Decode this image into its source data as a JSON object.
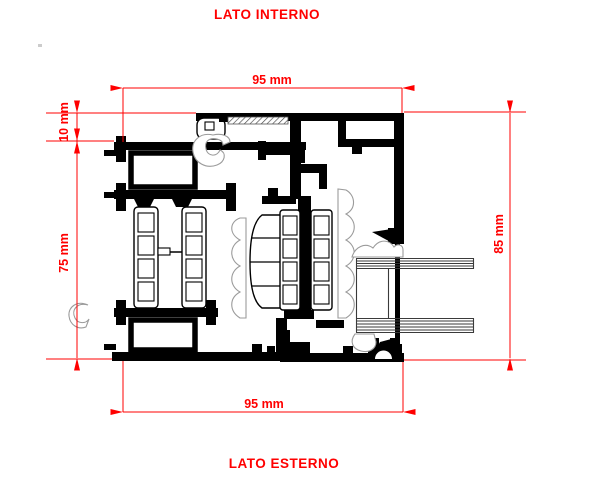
{
  "labels": {
    "top": "LATO INTERNO",
    "bottom": "LATO ESTERNO"
  },
  "dimensions": {
    "top_width": "95 mm",
    "bottom_width": "95 mm",
    "inset": "10 mm",
    "left_height": "75 mm",
    "right_height": "85 mm"
  },
  "colors": {
    "dimension": "#ff0000",
    "drawing": "#000000",
    "gasket": "#9b9b9b",
    "glass": "#3a3a3a",
    "background": "#ffffff"
  }
}
